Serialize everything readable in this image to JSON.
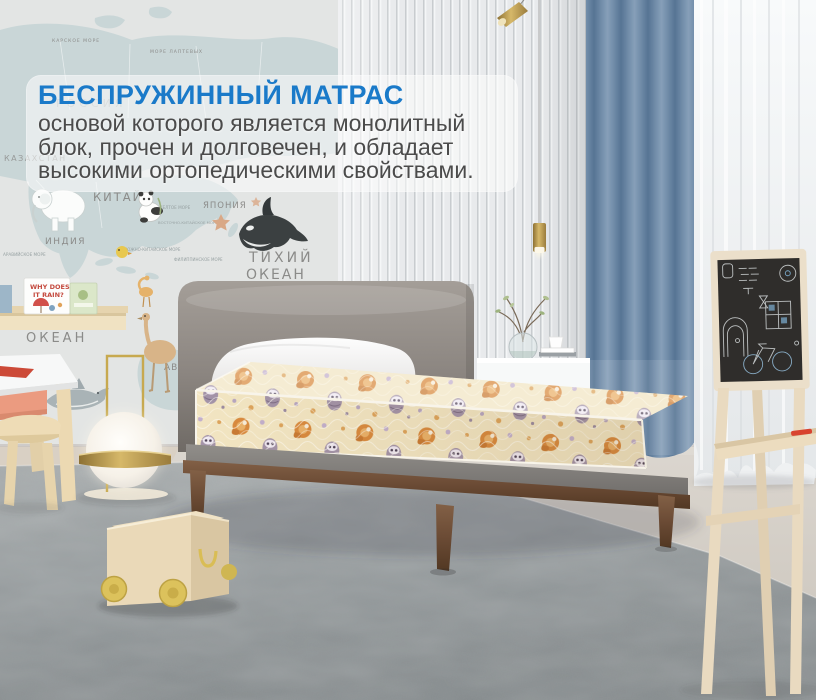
{
  "overlay": {
    "title": "БЕСПРУЖИННЫЙ МАТРАС",
    "lines": [
      "основой которого является монолитный",
      "блок, прочен и долговечен, и обладает",
      "высокими ортопедическими свойствами."
    ]
  },
  "wall_map_labels": {
    "kara_sea": "КАРСКОЕ МОРЕ",
    "laptev_sea": "МОРЕ ЛАПТЕВЫХ",
    "russia": "РОССИЯ",
    "kazakhstan": "КАЗАХСТАН",
    "china": "КИТАЙ",
    "japan": "ЯПОНИЯ",
    "india": "ИНДИЯ",
    "arabian_sea": "АРАВИЙСКОЕ МОРЕ",
    "yellow_sea": "ЖЕЛТОЕ МОРЕ",
    "east_china_sea": "ВОСТОЧНО-КИТАЙСКОЕ МОРЕ",
    "south_china_sea": "ЮЖНО-КИТАЙСКОЕ МОРЕ",
    "philippine_sea": "ФИЛИППИНСКОЕ МОРЕ",
    "pacific_1": "ТИХИЙ",
    "pacific_2": "ОКЕАН",
    "indian_ocean_1": "ИНД",
    "indian_ocean_2": "ОКЕАН",
    "australia_partial": "АВС"
  },
  "shelf_books": {
    "book1_title_1": "WHY DOES",
    "book1_title_2": "IT RAIN?"
  },
  "colors": {
    "accent_blue": "#1a7ac9",
    "body_text": "#4b4b4b",
    "curtain_blue": "#6c88a6",
    "mattress_cream": "#f2e5c2",
    "fox_orange": "#d98a3e",
    "owl_purple": "#a393a8",
    "bed_wood_brown": "#6b4b35",
    "headboard_gray": "#8b8580",
    "carpet_gray": "#8f9597",
    "chalkboard_dark": "#2f2d2b",
    "toy_wheel_yellow": "#dcc25c"
  }
}
